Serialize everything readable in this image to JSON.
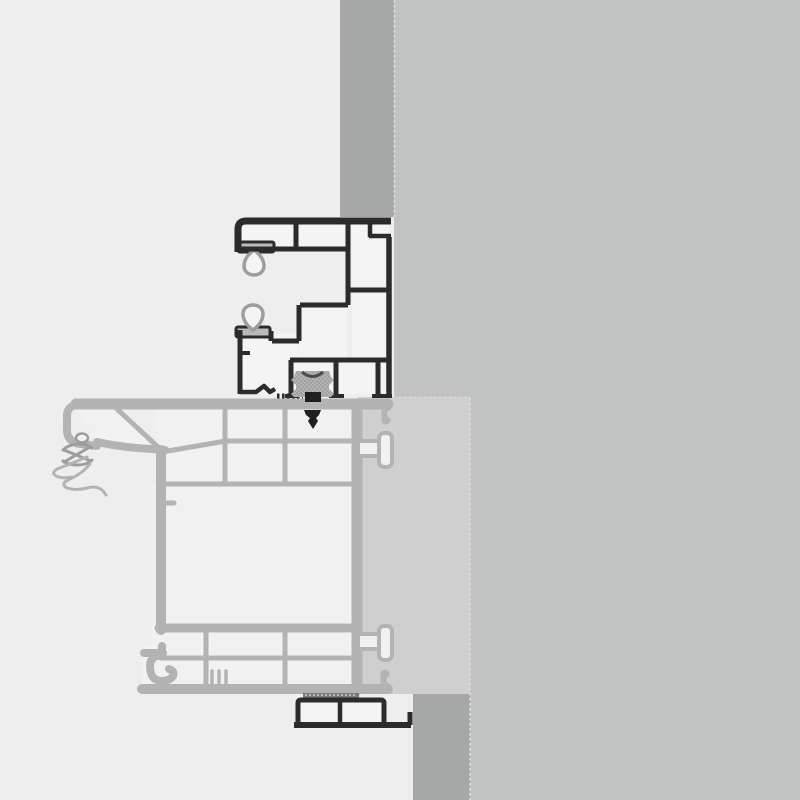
{
  "meta": {
    "description": "Technical cross-section detail drawing of a window frame installed against a masonry wall (no text labels in drawing)",
    "canvas": {
      "width": 800,
      "height": 800
    }
  },
  "components": {
    "masonry_wall": "Masonry wall",
    "plaster_reveal_top": "Wall reveal strip above frame",
    "plaster_reveal_bottom": "Wall reveal strip below trim",
    "insulation_panel": "Insulation / plaster panel behind extension profile",
    "window_frame_profile": "Multi-chamber window frame profile (highlighted black)",
    "frame_extension_profile": "Frame extension / shutter guide profile (gray)",
    "glazing_gasket_upper": "Upper sealing gasket",
    "glazing_gasket_lower": "Lower sealing gasket",
    "drip_edge": "Exterior drip edge with compression gasket",
    "wall_anchor_upper": "Upper wall anchor",
    "wall_anchor_lower": "Lower wall anchor",
    "retainer_clip": "Coupling retainer clip",
    "fixing_screw": "Fixing screw",
    "compression_tape": "Compression seal tape",
    "sill_trim_profile": "Interior sill trim profile"
  },
  "colors": {
    "background": "#eeeeee",
    "wall": "#c1c2c2",
    "reveal": "#a6a7a7",
    "panel": "#cfcfd0",
    "seam": "#dcdcdc",
    "frame_outline": "#2b2b2b",
    "frame_fill": "#f4f4f4",
    "profile_stroke": "#b2b4b4",
    "profile_fill": "#f1f1f1",
    "gasket_stroke": "#9c9e9e",
    "seal_gray": "#b9bbbb",
    "clip_fill": "#b1b3b3",
    "screw": "#1f1f1f",
    "tape": "#7a7a7a"
  }
}
